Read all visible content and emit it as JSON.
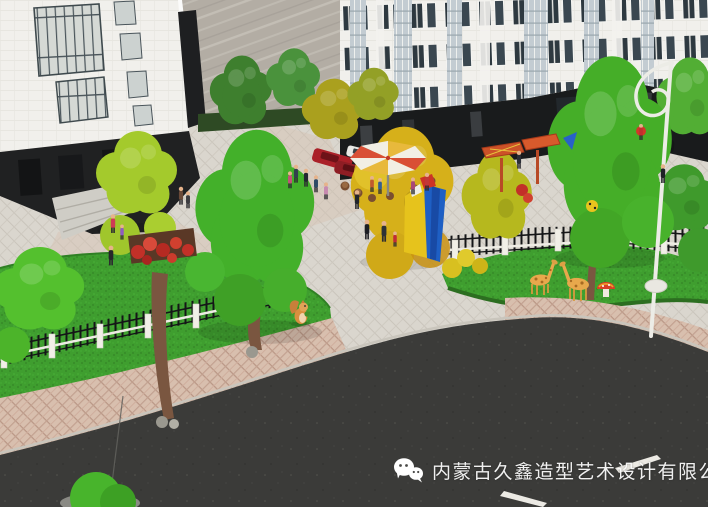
{
  "watermark": {
    "company_name": "内蒙古久鑫造型艺术设计有限公司",
    "icon": "wechat-icon"
  },
  "scene": {
    "description": "Aerial photograph of an architectural scale model: white apartment buildings around a landscaped courtyard plaza with miniature trees, lawns, fences, figurines and a curving asphalt road.",
    "objects": [
      "apartment-building-left",
      "marble-wall",
      "apartment-building-right",
      "courtyard-plaza",
      "lawn-left",
      "lawn-right",
      "white-post-fence",
      "iron-picket-fence",
      "green-trees",
      "yellow-trees",
      "red-flower-bed",
      "striped-umbrella",
      "log-stools",
      "pergola-canopies",
      "abstract-sculpture",
      "people-figurines",
      "red-cars",
      "white-car",
      "black-car",
      "squirrel-figurine",
      "giraffe-figurines",
      "mushroom-figurine",
      "street-lamp",
      "pink-paver-sidewalk",
      "asphalt-road",
      "road-marking-dashes",
      "roadside-bush"
    ],
    "colors": {
      "building_facade": "#f1f0ec",
      "building_plinth": "#1b1d1e",
      "marble_wall": "#b3ada4",
      "grass": "#3f9e2f",
      "tree_green": "#45ae28",
      "tree_lime": "#a4ca2c",
      "tree_yellow": "#d6b01a",
      "plaza_paver": "#d9d5cd",
      "sidewalk_pink": "#d8bfae",
      "asphalt": "#3b3b39",
      "umbrella_red": "#d94f35",
      "sculpture_blue": "#1e5fc4",
      "sculpture_yellow": "#e6c31c",
      "watermark_text": "#ffffff"
    }
  }
}
